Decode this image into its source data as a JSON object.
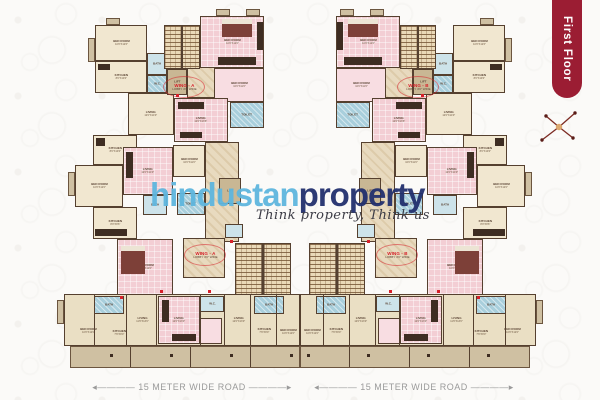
{
  "banner": {
    "label": "First Floor",
    "bg": "#9b1d33",
    "fg": "#ffffff"
  },
  "compass": {
    "icon": "compass-rose",
    "color": "#7c2a22"
  },
  "watermark": {
    "brand_light": "hindustan",
    "brand_dark": "property",
    "light_color": "#5fb6de",
    "dark_color": "#22306e",
    "tagline": "Think property, Think us"
  },
  "roads": {
    "left_label": "15 METER WIDE ROAD",
    "right_label": "15 METER WIDE ROAD"
  },
  "palette": {
    "cream": "#f1e7d0",
    "cream2": "#eadfc4",
    "pink": "#f3ced4",
    "pink2": "#f8dde2",
    "blue": "#a9cfdc",
    "blue2": "#cde3ea",
    "tan": "#cfc0a2",
    "marble": "#e8dabf",
    "lift": "#c9b794",
    "wall": "#55402f",
    "red": "#d6202a"
  },
  "plan": {
    "rooms": [
      {
        "x": 95,
        "y": 25,
        "w": 52,
        "h": 36,
        "f": "cream",
        "l": "BED ROOM",
        "d": "10'0\"X12'6\""
      },
      {
        "x": 95,
        "y": 61,
        "w": 52,
        "h": 32,
        "f": "cream",
        "l": "KITCHEN",
        "d": "8'0\"X10'0\""
      },
      {
        "x": 147,
        "y": 53,
        "w": 20,
        "h": 22,
        "f": "blue2",
        "l": "BATH"
      },
      {
        "x": 147,
        "y": 75,
        "w": 20,
        "h": 18,
        "f": "blue",
        "l": "W.C."
      },
      {
        "x": 128,
        "y": 93,
        "w": 46,
        "h": 42,
        "f": "cream",
        "l": "LIVING",
        "d": "12'0\"X14'0\""
      },
      {
        "x": 167,
        "y": 69,
        "w": 20,
        "h": 26,
        "f": "lift",
        "l": "LIFT"
      },
      {
        "x": 187,
        "y": 64,
        "w": 28,
        "h": 34,
        "f": "marble",
        "l": ""
      },
      {
        "x": 200,
        "y": 16,
        "w": 64,
        "h": 52,
        "f": "pink",
        "l": "BED ROOM",
        "d": "10'0\"X12'0\""
      },
      {
        "x": 214,
        "y": 68,
        "w": 50,
        "h": 34,
        "f": "pink2",
        "l": "BED ROOM",
        "d": "10'0\"X11'6\""
      },
      {
        "x": 230,
        "y": 102,
        "w": 34,
        "h": 26,
        "f": "blue",
        "l": "TOILET"
      },
      {
        "x": 174,
        "y": 98,
        "w": 54,
        "h": 44,
        "f": "pink",
        "l": "LIVING",
        "d": "12'0\"X13'6\""
      },
      {
        "x": 93,
        "y": 135,
        "w": 44,
        "h": 30,
        "f": "cream",
        "l": "KITCHEN",
        "d": "8'0\"X10'0\""
      },
      {
        "x": 75,
        "y": 165,
        "w": 48,
        "h": 42,
        "f": "cream",
        "l": "BED ROOM",
        "d": "10'0\"X12'0\""
      },
      {
        "x": 123,
        "y": 147,
        "w": 50,
        "h": 48,
        "f": "pink",
        "l": "LIVING",
        "d": "12'0\"X14'0\""
      },
      {
        "x": 143,
        "y": 195,
        "w": 24,
        "h": 20,
        "f": "blue2",
        "l": "BATH"
      },
      {
        "x": 93,
        "y": 207,
        "w": 44,
        "h": 32,
        "f": "cream",
        "l": "KITCHEN",
        "d": "8'0\"X9'6\""
      },
      {
        "x": 117,
        "y": 239,
        "w": 56,
        "h": 56,
        "f": "pink",
        "l": "BED ROOM",
        "d": "10'0\"X12'0\""
      },
      {
        "x": 173,
        "y": 145,
        "w": 32,
        "h": 32,
        "f": "cream",
        "l": "BED ROOM",
        "d": "10'0\"X11'0\""
      },
      {
        "x": 177,
        "y": 193,
        "w": 28,
        "h": 22,
        "f": "blue",
        "l": "TOILET"
      },
      {
        "x": 205,
        "y": 142,
        "w": 34,
        "h": 100,
        "f": "marble",
        "l": ""
      },
      {
        "x": 219,
        "y": 178,
        "w": 22,
        "h": 26,
        "f": "lift",
        "l": "LIFT"
      },
      {
        "x": 183,
        "y": 238,
        "w": 42,
        "h": 40,
        "f": "marble",
        "l": ""
      },
      {
        "x": 225,
        "y": 224,
        "w": 18,
        "h": 14,
        "f": "blue2",
        "l": ""
      },
      {
        "x": 64,
        "y": 294,
        "w": 236,
        "h": 52,
        "f": "cream2",
        "l": ""
      },
      {
        "x": 94,
        "y": 296,
        "w": 30,
        "h": 18,
        "f": "blue",
        "l": "BATH"
      },
      {
        "x": 158,
        "y": 296,
        "w": 42,
        "h": 48,
        "f": "pink",
        "l": "LIVING",
        "d": "12'0\"X13'0\""
      },
      {
        "x": 200,
        "y": 296,
        "w": 24,
        "h": 16,
        "f": "blue2",
        "l": "W.C."
      },
      {
        "x": 200,
        "y": 318,
        "w": 22,
        "h": 26,
        "f": "pink2",
        "l": ""
      },
      {
        "x": 254,
        "y": 296,
        "w": 30,
        "h": 18,
        "f": "blue",
        "l": "BATH"
      },
      {
        "x": 70,
        "y": 316,
        "w": 36,
        "h": 30,
        "f": "none",
        "l": "BED ROOM",
        "d": "10'0\"X12'0\""
      },
      {
        "x": 104,
        "y": 320,
        "w": 30,
        "h": 26,
        "f": "none",
        "l": "KITCHEN",
        "d": "7'6\"X9'0\""
      },
      {
        "x": 128,
        "y": 300,
        "w": 30,
        "h": 40,
        "f": "none",
        "l": "LIVING",
        "d": "11'6\"X13'0\""
      },
      {
        "x": 224,
        "y": 300,
        "w": 30,
        "h": 40,
        "f": "none",
        "l": "LIVING",
        "d": "12'0\"X13'0\""
      },
      {
        "x": 252,
        "y": 318,
        "w": 24,
        "h": 26,
        "f": "none",
        "l": "KITCHEN",
        "d": "7'6\"X9'0\""
      },
      {
        "x": 276,
        "y": 318,
        "w": 24,
        "h": 28,
        "f": "none",
        "l": "BED ROOM",
        "d": "10'0\"X12'0\""
      },
      {
        "x": 70,
        "y": 346,
        "w": 230,
        "h": 22,
        "f": "tan",
        "l": ""
      },
      {
        "x": 106,
        "y": 18,
        "w": 14,
        "h": 7,
        "f": "tan",
        "l": ""
      },
      {
        "x": 216,
        "y": 9,
        "w": 14,
        "h": 7,
        "f": "tan",
        "l": ""
      },
      {
        "x": 246,
        "y": 9,
        "w": 14,
        "h": 7,
        "f": "tan",
        "l": ""
      },
      {
        "x": 88,
        "y": 38,
        "w": 7,
        "h": 24,
        "f": "tan",
        "l": ""
      },
      {
        "x": 68,
        "y": 172,
        "w": 7,
        "h": 24,
        "f": "tan",
        "l": ""
      },
      {
        "x": 57,
        "y": 300,
        "w": 7,
        "h": 24,
        "f": "tan",
        "l": ""
      }
    ],
    "stairs": [
      {
        "x": 164,
        "y": 25,
        "w": 36,
        "h": 44
      },
      {
        "x": 235,
        "y": 243,
        "w": 56,
        "h": 52
      }
    ],
    "walls": [
      {
        "x": 94,
        "y": 294,
        "h": 52
      },
      {
        "x": 126,
        "y": 294,
        "h": 52
      },
      {
        "x": 156,
        "y": 294,
        "h": 52
      },
      {
        "x": 200,
        "y": 294,
        "h": 52
      },
      {
        "x": 224,
        "y": 294,
        "h": 52
      },
      {
        "x": 250,
        "y": 294,
        "h": 52
      },
      {
        "x": 276,
        "y": 294,
        "h": 52
      },
      {
        "x": 299,
        "y": 294,
        "h": 52
      },
      {
        "x": 130,
        "y": 347,
        "h": 20
      },
      {
        "x": 190,
        "y": 347,
        "h": 20
      },
      {
        "x": 250,
        "y": 347,
        "h": 20
      }
    ],
    "furniture": [
      {
        "x": 222,
        "y": 19,
        "w": 30,
        "h": 18,
        "c": "#7d4038"
      },
      {
        "x": 222,
        "y": 19,
        "w": 30,
        "h": 5,
        "c": "#ece4d4"
      },
      {
        "x": 257,
        "y": 22,
        "w": 6,
        "h": 28,
        "c": "#3e2d22"
      },
      {
        "x": 218,
        "y": 57,
        "w": 38,
        "h": 8,
        "c": "#3e2d22"
      },
      {
        "x": 178,
        "y": 102,
        "w": 26,
        "h": 7,
        "c": "#3e2d22"
      },
      {
        "x": 180,
        "y": 132,
        "w": 22,
        "h": 6,
        "c": "#3e2d22"
      },
      {
        "x": 126,
        "y": 152,
        "w": 7,
        "h": 26,
        "c": "#3e2d22"
      },
      {
        "x": 95,
        "y": 229,
        "w": 32,
        "h": 7,
        "c": "#3e2d22"
      },
      {
        "x": 121,
        "y": 246,
        "w": 24,
        "h": 28,
        "c": "#7d4038"
      },
      {
        "x": 121,
        "y": 246,
        "w": 24,
        "h": 5,
        "c": "#ece4d4"
      },
      {
        "x": 162,
        "y": 300,
        "w": 7,
        "h": 22,
        "c": "#3e2d22"
      },
      {
        "x": 172,
        "y": 334,
        "w": 24,
        "h": 7,
        "c": "#3e2d22"
      },
      {
        "x": 98,
        "y": 64,
        "w": 12,
        "h": 6,
        "c": "#3e2d22"
      },
      {
        "x": 96,
        "y": 138,
        "w": 9,
        "h": 8,
        "c": "#3e2d22"
      }
    ],
    "columns": [
      {
        "x": 110,
        "y": 354
      },
      {
        "x": 170,
        "y": 354
      },
      {
        "x": 230,
        "y": 354
      },
      {
        "x": 290,
        "y": 354
      }
    ],
    "markers": [
      {
        "x": 208,
        "y": 290
      },
      {
        "x": 160,
        "y": 290
      },
      {
        "x": 176,
        "y": 94
      },
      {
        "x": 230,
        "y": 240
      },
      {
        "x": 120,
        "y": 296
      }
    ],
    "wing_labels": [
      {
        "x": 163,
        "y": 76,
        "w": 40,
        "h": 20,
        "title": "WING - A",
        "sub": "LOBBY 4'6\" WIDE"
      },
      {
        "x": 184,
        "y": 244,
        "w": 40,
        "h": 20,
        "title": "WING - A",
        "sub": "LOBBY 4'6\" WIDE"
      },
      {
        "x": 397,
        "y": 76,
        "w": 40,
        "h": 20,
        "title": "WING - B",
        "sub": "LOBBY 4'6\" WIDE"
      },
      {
        "x": 376,
        "y": 244,
        "w": 40,
        "h": 20,
        "title": "WING - B",
        "sub": "LOBBY 4'6\" WIDE"
      }
    ]
  }
}
